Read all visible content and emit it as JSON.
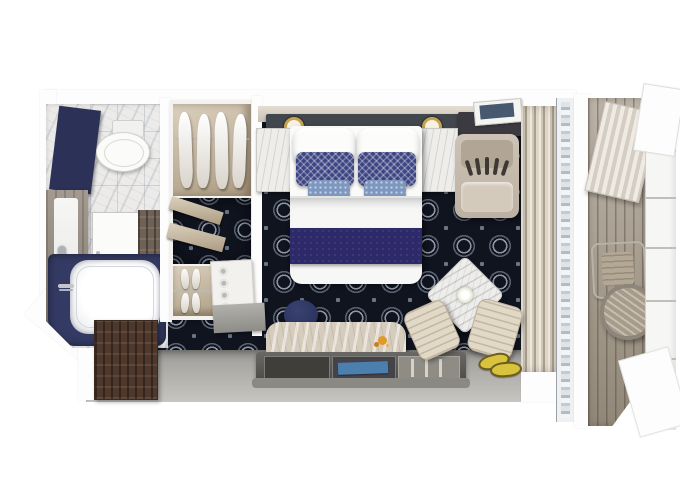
{
  "scene": {
    "type": "cruise-stateroom-floor-plan-3d-top-view",
    "rooms": [
      {
        "id": "bathroom",
        "label": "Bathroom"
      },
      {
        "id": "wardrobe",
        "label": "Wardrobe"
      },
      {
        "id": "bedroom",
        "label": "Bedroom"
      },
      {
        "id": "sitting-area",
        "label": "Sitting area"
      },
      {
        "id": "entry",
        "label": "Entry"
      },
      {
        "id": "balcony",
        "label": "Balcony"
      }
    ],
    "furniture": [
      "toilet",
      "vanity-counter",
      "shower-door",
      "tall-cabinet",
      "bathtub",
      "hanging-clothes",
      "open-shelves",
      "shoe-shelf",
      "minibar-console",
      "king-bed",
      "white-pillows",
      "navy-accent-pillows",
      "blue-accent-pillows",
      "bed-runner",
      "nightstand-left",
      "nightstand-right",
      "wall-lamps",
      "lounge-chair",
      "desk-with-tablet",
      "curtains",
      "sliding-glass-door",
      "sofa",
      "console-table",
      "navy-ottoman",
      "marble-side-table",
      "armchair-left",
      "armchair-right",
      "sandals",
      "entry-door",
      "balcony-deck",
      "balcony-chair",
      "balcony-round-table",
      "privacy-partition"
    ]
  },
  "palette": {
    "carpet": "#10141f",
    "carpetRing": "#8e96a4",
    "navyRunner": "#2d2a6a",
    "pillowNavy": "#3d4583",
    "pillowBlue": "#7e97bf",
    "tubNavy": "#333a63",
    "bathPanelNavy": "#2c3257",
    "wallWhite": "#fdfdfd",
    "wood": "#c8b89c",
    "darkWood": "#4e382c",
    "deckPlank": "#a29786",
    "sofaBeige": "#d6ccbe",
    "grayFloor": "#b0afa9",
    "charcoal": "#42464d",
    "gold": "#c8a34e",
    "marble": "#ecebe9",
    "sandal": "#d8c23e",
    "magazine": "#4a7fae",
    "pouf": "#2b3560"
  }
}
